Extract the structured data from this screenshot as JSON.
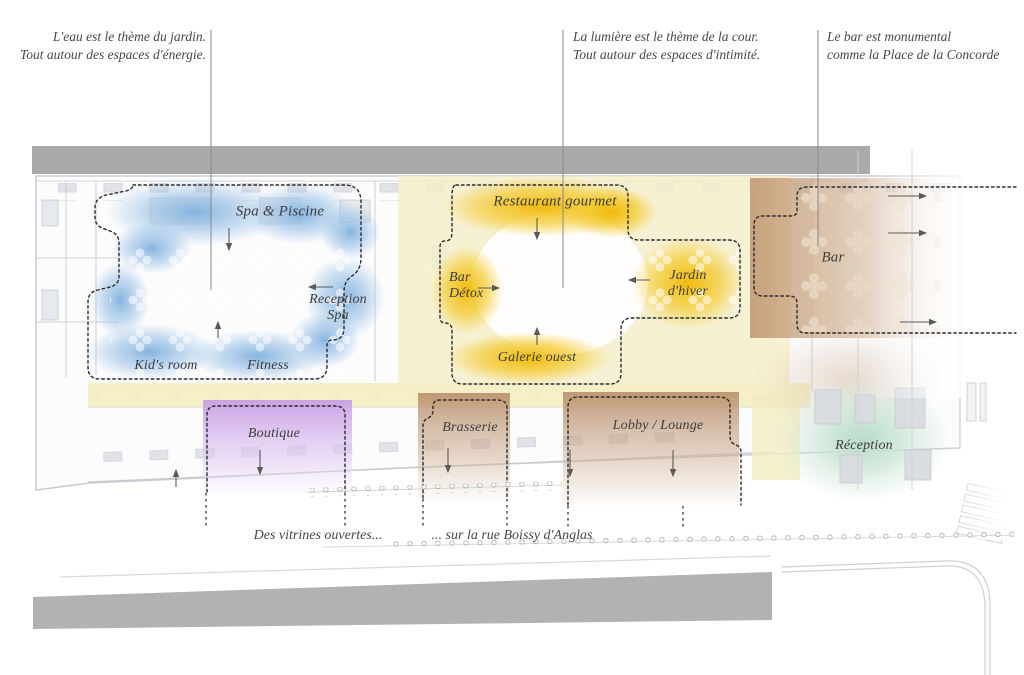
{
  "annotations": {
    "garden": {
      "line1": "L'eau est le thème du jardin.",
      "line2": "Tout autour des espaces d'énergie."
    },
    "court": {
      "line1": "La lumière est le thème de la cour.",
      "line2": "Tout autour des espaces d'intimité."
    },
    "bar_note": {
      "line1": "Le bar est monumental",
      "line2": "comme la Place de la Concorde"
    },
    "vitrines": "Des vitrines ouvertes...",
    "rue": "... sur la rue Boissy d'Anglas"
  },
  "zones": {
    "spa_piscine": "Spa & Piscine",
    "reception_spa_line1": "Reception",
    "reception_spa_line2": "Spa",
    "kids_room": "Kid's room",
    "fitness": "Fitness",
    "boutique": "Boutique",
    "restaurant_gourmet": "Restaurant gourmet",
    "bar_detox_line1": "Bar",
    "bar_detox_line2": "Détox",
    "jardin_hiver_line1": "Jardin",
    "jardin_hiver_line2": "d'hiver",
    "galerie_ouest": "Galerie ouest",
    "brasserie": "Brasserie",
    "lobby_lounge": "Lobby / Lounge",
    "bar": "Bar",
    "reception": "Réception"
  },
  "colors": {
    "spa_blue": "#7fb0dd",
    "court_yellow": "#f1b703",
    "pale_yellow": "#f6efc6",
    "boutique_purple": "#c79fe6",
    "brown": "#b98f6c",
    "reception_green": "#b7dcc8",
    "street_gray": "#a9a9a9",
    "text": "#474747"
  }
}
